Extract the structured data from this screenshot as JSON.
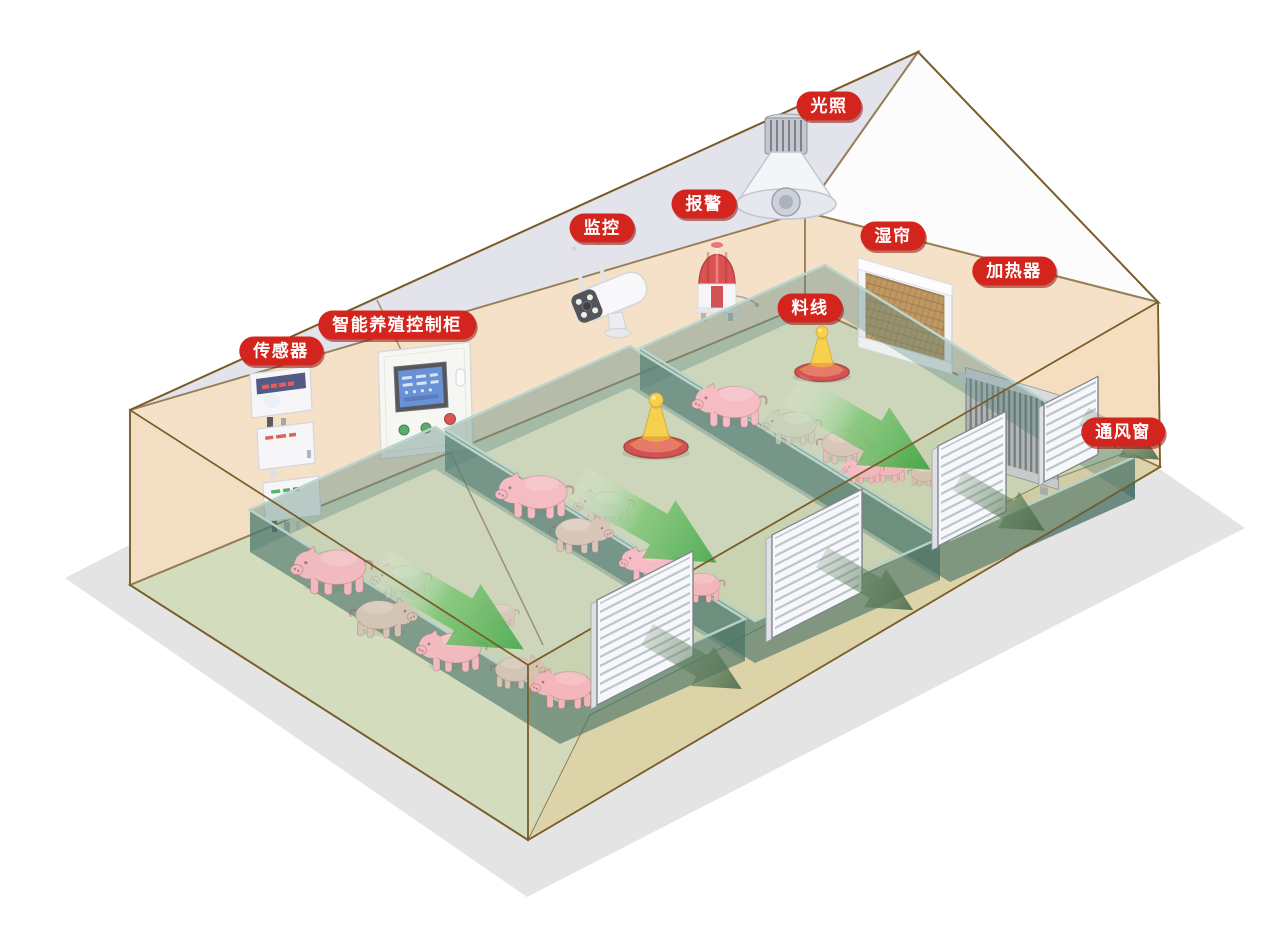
{
  "scene": {
    "labels": [
      {
        "id": "lighting",
        "text": "光照"
      },
      {
        "id": "alarm",
        "text": "报警"
      },
      {
        "id": "monitoring",
        "text": "监控"
      },
      {
        "id": "wet-curtain",
        "text": "湿帘"
      },
      {
        "id": "heater",
        "text": "加热器"
      },
      {
        "id": "feed-line",
        "text": "料线"
      },
      {
        "id": "control-cabinet",
        "text": "智能养殖控制柜"
      },
      {
        "id": "sensor",
        "text": "传感器"
      },
      {
        "id": "vent-window",
        "text": "通风窗"
      }
    ],
    "colors": {
      "label_bg": "#d4241e",
      "label_text": "#ffffff",
      "wall_tan": "#f3d9b8",
      "roof_inner_lavender": "#dcdbe7",
      "gable_white": "#fbfbfd",
      "floor_green": "#ccd5b0",
      "walkway_khaki": "#d6cd9c",
      "ground_shadow": "#e4e4e5",
      "frame_brown": "#7a5c28",
      "floor_edge_olive": "#6b6b3d",
      "pen_glass_teal": "#2f6a5e",
      "airflow_green": "#2aa12c",
      "exhaust_green": "#5d7f5f",
      "pig_pink": "#f2aab2",
      "feeder_red": "#c62322",
      "feeder_yellow": "#f4c41c",
      "equipment_white": "#f4f4f6",
      "heater_gray": "#a7adb5",
      "wet_pad_brown": "#ad7a35",
      "screen_blue": "#3f72c9",
      "alarm_red": "#d32120"
    }
  }
}
